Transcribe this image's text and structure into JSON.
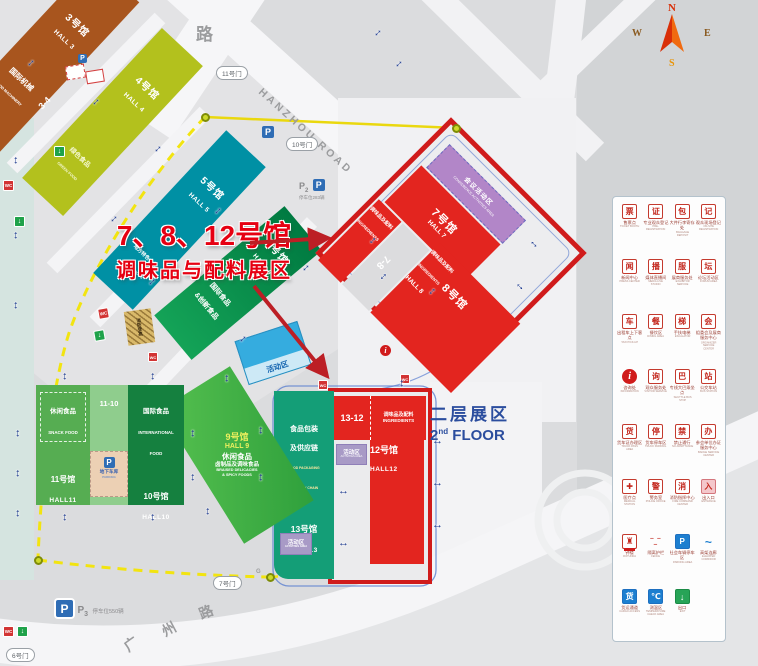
{
  "overlay": {
    "title_line1": "7、8、12号馆",
    "title_line2": "调味品与配料展区"
  },
  "floor2": {
    "zh": "二层展区",
    "num": "2",
    "sup": "nd",
    "word": "FLOOR"
  },
  "compass": {
    "n": "N",
    "w": "W",
    "e": "E",
    "s": "S"
  },
  "roads": {
    "hanzhou": "HANZHOU ROAD",
    "top_char": "路",
    "gz1": "广",
    "gz2": "州",
    "gz3": "路",
    "g_mark": "G"
  },
  "gates": {
    "g6": "6号门",
    "g7": "7号门",
    "g10": "10号门",
    "g11": "11号门"
  },
  "parking": {
    "p_letter": "P",
    "p3_sub": "3",
    "p2_sub": "2",
    "p3_spaces": "停车位550辆",
    "p2_spaces": "停车位283辆",
    "underground_zh": "地下车库",
    "underground_en": "PARKING"
  },
  "halls": {
    "h3": {
      "no": "3号馆",
      "en": "HALL 3",
      "zone_zh": "国际机械",
      "zone_en": "FOOD MACHINERY"
    },
    "h4": {
      "no": "4号馆",
      "en": "HALL 4",
      "zone_zh": "绿色食品",
      "zone_en": "GREEN FOOD"
    },
    "h5": {
      "no": "5号馆",
      "en": "HALL 5",
      "zone_zh": "地方特色食品",
      "zone_en": "LOCAL FOODS"
    },
    "h6": {
      "no": "6号馆",
      "en": "HALL 6",
      "zone_zh1": "国际食品",
      "zone_zh2": "&创新食品"
    },
    "h7": {
      "no": "7号馆",
      "en": "HALL 7"
    },
    "h8": {
      "no": "8号馆",
      "en": "HALL 8"
    },
    "h9": {
      "no": "9号馆",
      "en": "HALL 9",
      "l1": "休闲食品",
      "l2": "卤制品及调味食品",
      "l3": "BRAISED DELICACIES",
      "l4": "& SPICY FOODS"
    },
    "h10": {
      "no": "10号馆",
      "en": "HALL10",
      "zone_zh": "国际食品",
      "zone_en1": "INTERNATIONAL",
      "zone_en2": "FOOD"
    },
    "h11": {
      "no": "11号馆",
      "en": "HALL11",
      "zone_zh": "休闲食品",
      "zone_en": "SNACK FOOD"
    },
    "h12": {
      "no": "12号馆",
      "en": "HALL12"
    },
    "h13": {
      "no": "13号馆",
      "en": "HALL13",
      "zone_zh1": "食品包装",
      "zone_zh2": "及供应链",
      "zone_en1": "FOOD PACKAGING",
      "zone_en2": "& SUPPLY CHAIN"
    }
  },
  "connectors": {
    "c34": "3-4",
    "c78": "7-8",
    "c1110": "11-10",
    "c1312": "13-12"
  },
  "zones": {
    "conference_zh": "会议活动区",
    "conference_en": "CONFERENCE ACTIVITIES AREA",
    "ingredients_zh": "调味品及配料",
    "ingredients_en": "INGREDIENTS",
    "activity": "活动区",
    "activity_en": "ACTIVITIES AREA",
    "fire_ladder": "消防登高"
  },
  "icons": {
    "wc": "WC",
    "exit_arrow": "↓",
    "info_i": "i"
  },
  "colors": {
    "red_zone_border": "#d01b1b",
    "hall_red": "#e3251f",
    "accent_red": "#e60012",
    "teal5": "#0090a4",
    "green6": "#00a14e",
    "green9": "#46b549",
    "green10": "#15803f",
    "green11": "#56ad52",
    "teal13": "#149e77",
    "yellow4": "#b3c11d",
    "brown3": "#a8551e",
    "purple": "#b286c8",
    "blue_activity": "#35acdf",
    "route_yellow": "#f2e410",
    "arrow_blue": "#1d3a8f",
    "floor_blue": "#2b4d9e"
  },
  "legend": {
    "items": [
      {
        "zh": "售票点",
        "en": "TICKET BOOTH",
        "g": "票",
        "v": "red"
      },
      {
        "zh": "专业观众登记",
        "en": "PRE-REGISTRATION",
        "g": "证",
        "v": "red"
      },
      {
        "zh": "大件行李寄存处",
        "en": "BAGGAGE DEPOSIT",
        "g": "包",
        "v": "red"
      },
      {
        "zh": "观众现场登记",
        "en": "ON-SITE REGISTRATION",
        "g": "记",
        "v": "red"
      },
      {
        "zh": "新闻中心",
        "en": "PRESS CENTER",
        "g": "闻",
        "v": "red"
      },
      {
        "zh": "媒体直播间",
        "en": "MEDIA LIVE STUDIO",
        "g": "播",
        "v": "red"
      },
      {
        "zh": "展商服务处",
        "en": "EXHIBITOR SERVICE",
        "g": "服",
        "v": "red"
      },
      {
        "zh": "论坛活动区",
        "en": "FORUM AREA",
        "g": "坛",
        "v": "red"
      },
      {
        "zh": "出租车上下客点",
        "en": "TAXI PICK-UP",
        "g": "车",
        "v": "red"
      },
      {
        "zh": "餐饮区",
        "en": "DINING AREA",
        "g": "餐",
        "v": "red"
      },
      {
        "zh": "手扶电梯",
        "en": "ESCALATOR",
        "g": "梯",
        "v": "red"
      },
      {
        "zh": "组委会及展商服务中心",
        "en": "ORGANIZER SERVICE CENTER",
        "g": "会",
        "v": "red"
      },
      {
        "zh": "咨询处",
        "en": "INFORMATION",
        "g": "i",
        "v": "circle"
      },
      {
        "zh": "观众服务处",
        "en": "VISITOR SERVICE",
        "g": "询",
        "v": "red"
      },
      {
        "zh": "专线大巴乘坐点",
        "en": "SHUTTLE BUS STOP",
        "g": "巴",
        "v": "red"
      },
      {
        "zh": "公交车站",
        "en": "BUS STATION",
        "g": "站",
        "v": "red"
      },
      {
        "zh": "货车证办理区",
        "en": "TRUCK PASS AREA",
        "g": "货",
        "v": "red"
      },
      {
        "zh": "货车停车区",
        "en": "TRUCK PARKING",
        "g": "停",
        "v": "red"
      },
      {
        "zh": "禁止通行",
        "en": "NO ADMITTANCE",
        "g": "禁",
        "v": "red"
      },
      {
        "zh": "参会单位办证服务中心",
        "en": "BADGE SERVICE CENTER",
        "g": "办",
        "v": "red"
      },
      {
        "zh": "医疗点",
        "en": "MEDICAL STATION",
        "g": "✚",
        "v": "red"
      },
      {
        "zh": "警务室",
        "en": "POLICE OFFICE",
        "g": "警",
        "v": "red"
      },
      {
        "zh": "消防指挥中心",
        "en": "FIRE COMMAND CENTER",
        "g": "消",
        "v": "red"
      },
      {
        "zh": "出入口",
        "en": "ENTRANCE",
        "g": "入",
        "v": "pink"
      },
      {
        "zh": "钟楼",
        "en": "ROTUNDA",
        "g": "♜",
        "v": "tower"
      },
      {
        "zh": "隔离护栏",
        "en": "FENCE",
        "g": "‒ ‒ ‒",
        "v": "fence"
      },
      {
        "zh": "社会车辆停车区",
        "en": "PARKING AREA",
        "g": "P",
        "v": "bluebox"
      },
      {
        "zh": "高架连廊",
        "en": "ELEVATED CORRIDOR",
        "g": "~",
        "v": "plainblue"
      },
      {
        "zh": "货运通道",
        "en": "CARGO ACCESS",
        "g": "货",
        "v": "bluebox"
      },
      {
        "zh": "测温区",
        "en": "TEMPERATURE CHECK AREA",
        "g": "℃",
        "v": "bluebox"
      },
      {
        "zh": "出口",
        "en": "EXIT",
        "g": "↓",
        "v": "green"
      }
    ]
  }
}
